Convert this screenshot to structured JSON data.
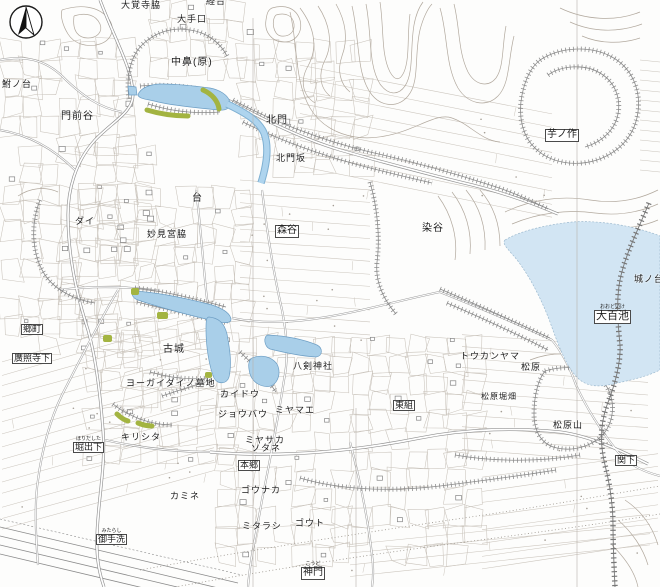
{
  "map": {
    "compass_icon": "north-arrow-compass",
    "colors": {
      "stream_water": "#a9cfe9",
      "large_pond": "#d2e5f3",
      "vegetation": "#a3b441",
      "contour": "#b2a99e",
      "cliff_hachure": "#8f8f8f",
      "road": "#909090",
      "label_text": "#1c1c1c",
      "background": "#fdfdfc"
    },
    "labels": [
      {
        "text": "大覚寺脇",
        "x": 121,
        "y": 1,
        "size": 9,
        "box": false
      },
      {
        "text": "経台",
        "x": 206,
        "y": -3,
        "size": 9,
        "box": false
      },
      {
        "text": "大手口",
        "x": 177,
        "y": 15,
        "size": 9,
        "box": false
      },
      {
        "text": "中鼻(原)",
        "x": 171,
        "y": 58,
        "size": 10,
        "box": false
      },
      {
        "text": "鮒ノ台",
        "x": 2,
        "y": 80,
        "size": 9,
        "box": false
      },
      {
        "text": "門前谷",
        "x": 61,
        "y": 112,
        "size": 10,
        "box": false
      },
      {
        "text": "北門",
        "x": 266,
        "y": 116,
        "size": 10,
        "box": false
      },
      {
        "text": "芋ノ作",
        "x": 545,
        "y": 129,
        "size": 10,
        "box": true
      },
      {
        "text": "北門坂",
        "x": 276,
        "y": 154,
        "size": 9,
        "box": false
      },
      {
        "text": "台",
        "x": 192,
        "y": 194,
        "size": 10,
        "box": false
      },
      {
        "text": "ダイ",
        "x": 75,
        "y": 217,
        "size": 9,
        "box": false
      },
      {
        "text": "染谷",
        "x": 422,
        "y": 224,
        "size": 10,
        "box": false
      },
      {
        "text": "森谷",
        "x": 275,
        "y": 225,
        "size": 10,
        "box": true
      },
      {
        "text": "妙見宮脇",
        "x": 147,
        "y": 230,
        "size": 9,
        "box": false
      },
      {
        "text": "城ノ台",
        "x": 634,
        "y": 275,
        "size": 9,
        "box": false
      },
      {
        "text": "大百池",
        "x": 594,
        "y": 310,
        "size": 11,
        "box": true,
        "ruby": "おおどいけ"
      },
      {
        "text": "郷町",
        "x": 21,
        "y": 324,
        "size": 9,
        "box": true
      },
      {
        "text": "古城",
        "x": 163,
        "y": 345,
        "size": 10,
        "box": false
      },
      {
        "text": "トウカンヤマ",
        "x": 460,
        "y": 352,
        "size": 9,
        "box": false
      },
      {
        "text": "廣照寺下",
        "x": 12,
        "y": 353,
        "size": 9,
        "box": true
      },
      {
        "text": "八剣神社",
        "x": 293,
        "y": 362,
        "size": 9,
        "box": false
      },
      {
        "text": "松原",
        "x": 521,
        "y": 363,
        "size": 9,
        "box": false
      },
      {
        "text": "ヨーガイダイノ墓地",
        "x": 126,
        "y": 379,
        "size": 9,
        "box": false
      },
      {
        "text": "カイドウ",
        "x": 220,
        "y": 390,
        "size": 9,
        "box": false
      },
      {
        "text": "松原堀畑",
        "x": 481,
        "y": 393,
        "size": 8,
        "box": false
      },
      {
        "text": "東組",
        "x": 393,
        "y": 400,
        "size": 9,
        "box": true
      },
      {
        "text": "ミヤマエ",
        "x": 275,
        "y": 406,
        "size": 9,
        "box": false
      },
      {
        "text": "ジョウバウ",
        "x": 218,
        "y": 410,
        "size": 9,
        "box": false
      },
      {
        "text": "松原山",
        "x": 553,
        "y": 421,
        "size": 9,
        "box": false
      },
      {
        "text": "キリシタ",
        "x": 121,
        "y": 433,
        "size": 9,
        "box": false
      },
      {
        "text": "ミヤサカ",
        "x": 245,
        "y": 436,
        "size": 9,
        "box": false
      },
      {
        "text": "堀出下",
        "x": 73,
        "y": 442,
        "size": 9,
        "box": true,
        "ruby": "ほりだした"
      },
      {
        "text": "ソタネ",
        "x": 251,
        "y": 444,
        "size": 9,
        "box": false
      },
      {
        "text": "関下",
        "x": 615,
        "y": 455,
        "size": 9,
        "box": true
      },
      {
        "text": "本郷",
        "x": 238,
        "y": 460,
        "size": 9,
        "box": true
      },
      {
        "text": "ゴウナカ",
        "x": 241,
        "y": 486,
        "size": 9,
        "box": false
      },
      {
        "text": "カミネ",
        "x": 170,
        "y": 492,
        "size": 9,
        "box": false
      },
      {
        "text": "ゴウト",
        "x": 295,
        "y": 519,
        "size": 9,
        "box": false
      },
      {
        "text": "ミタラシ",
        "x": 242,
        "y": 522,
        "size": 9,
        "box": false
      },
      {
        "text": "御手洗",
        "x": 96,
        "y": 534,
        "size": 9,
        "box": true,
        "ruby": "みたらし"
      },
      {
        "text": "神門",
        "x": 301,
        "y": 567,
        "size": 10,
        "box": true,
        "ruby": "こうど"
      }
    ]
  }
}
